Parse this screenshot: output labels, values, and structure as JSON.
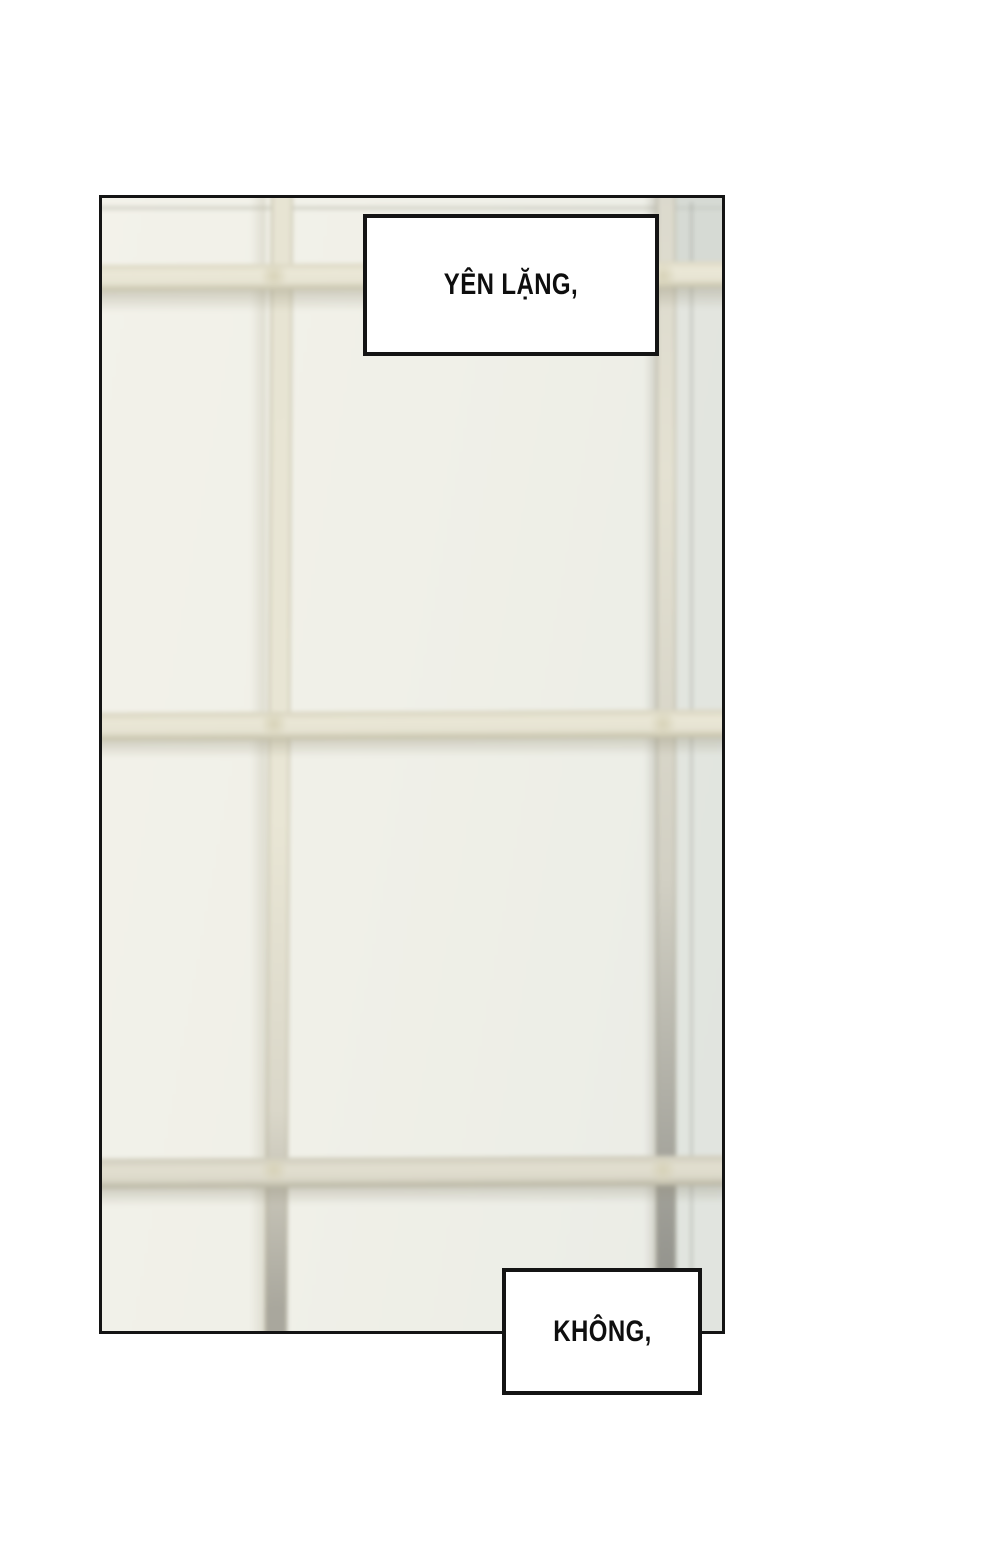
{
  "page": {
    "background_color": "#ffffff",
    "kind": "webtoon-comic-page"
  },
  "panel": {
    "border_color": "#141414",
    "photo_description": "blurred photo of white window with cream muntin grid",
    "glass_color": "#f0efe7",
    "muntin_color": "#e9e6d5",
    "muntin_shadow_color": "#c6c2aa"
  },
  "captions": {
    "top": {
      "text": "YÊN LẶNG,"
    },
    "bottom": {
      "text": "KHÔNG,"
    }
  },
  "text_color": "#0e0e0e"
}
